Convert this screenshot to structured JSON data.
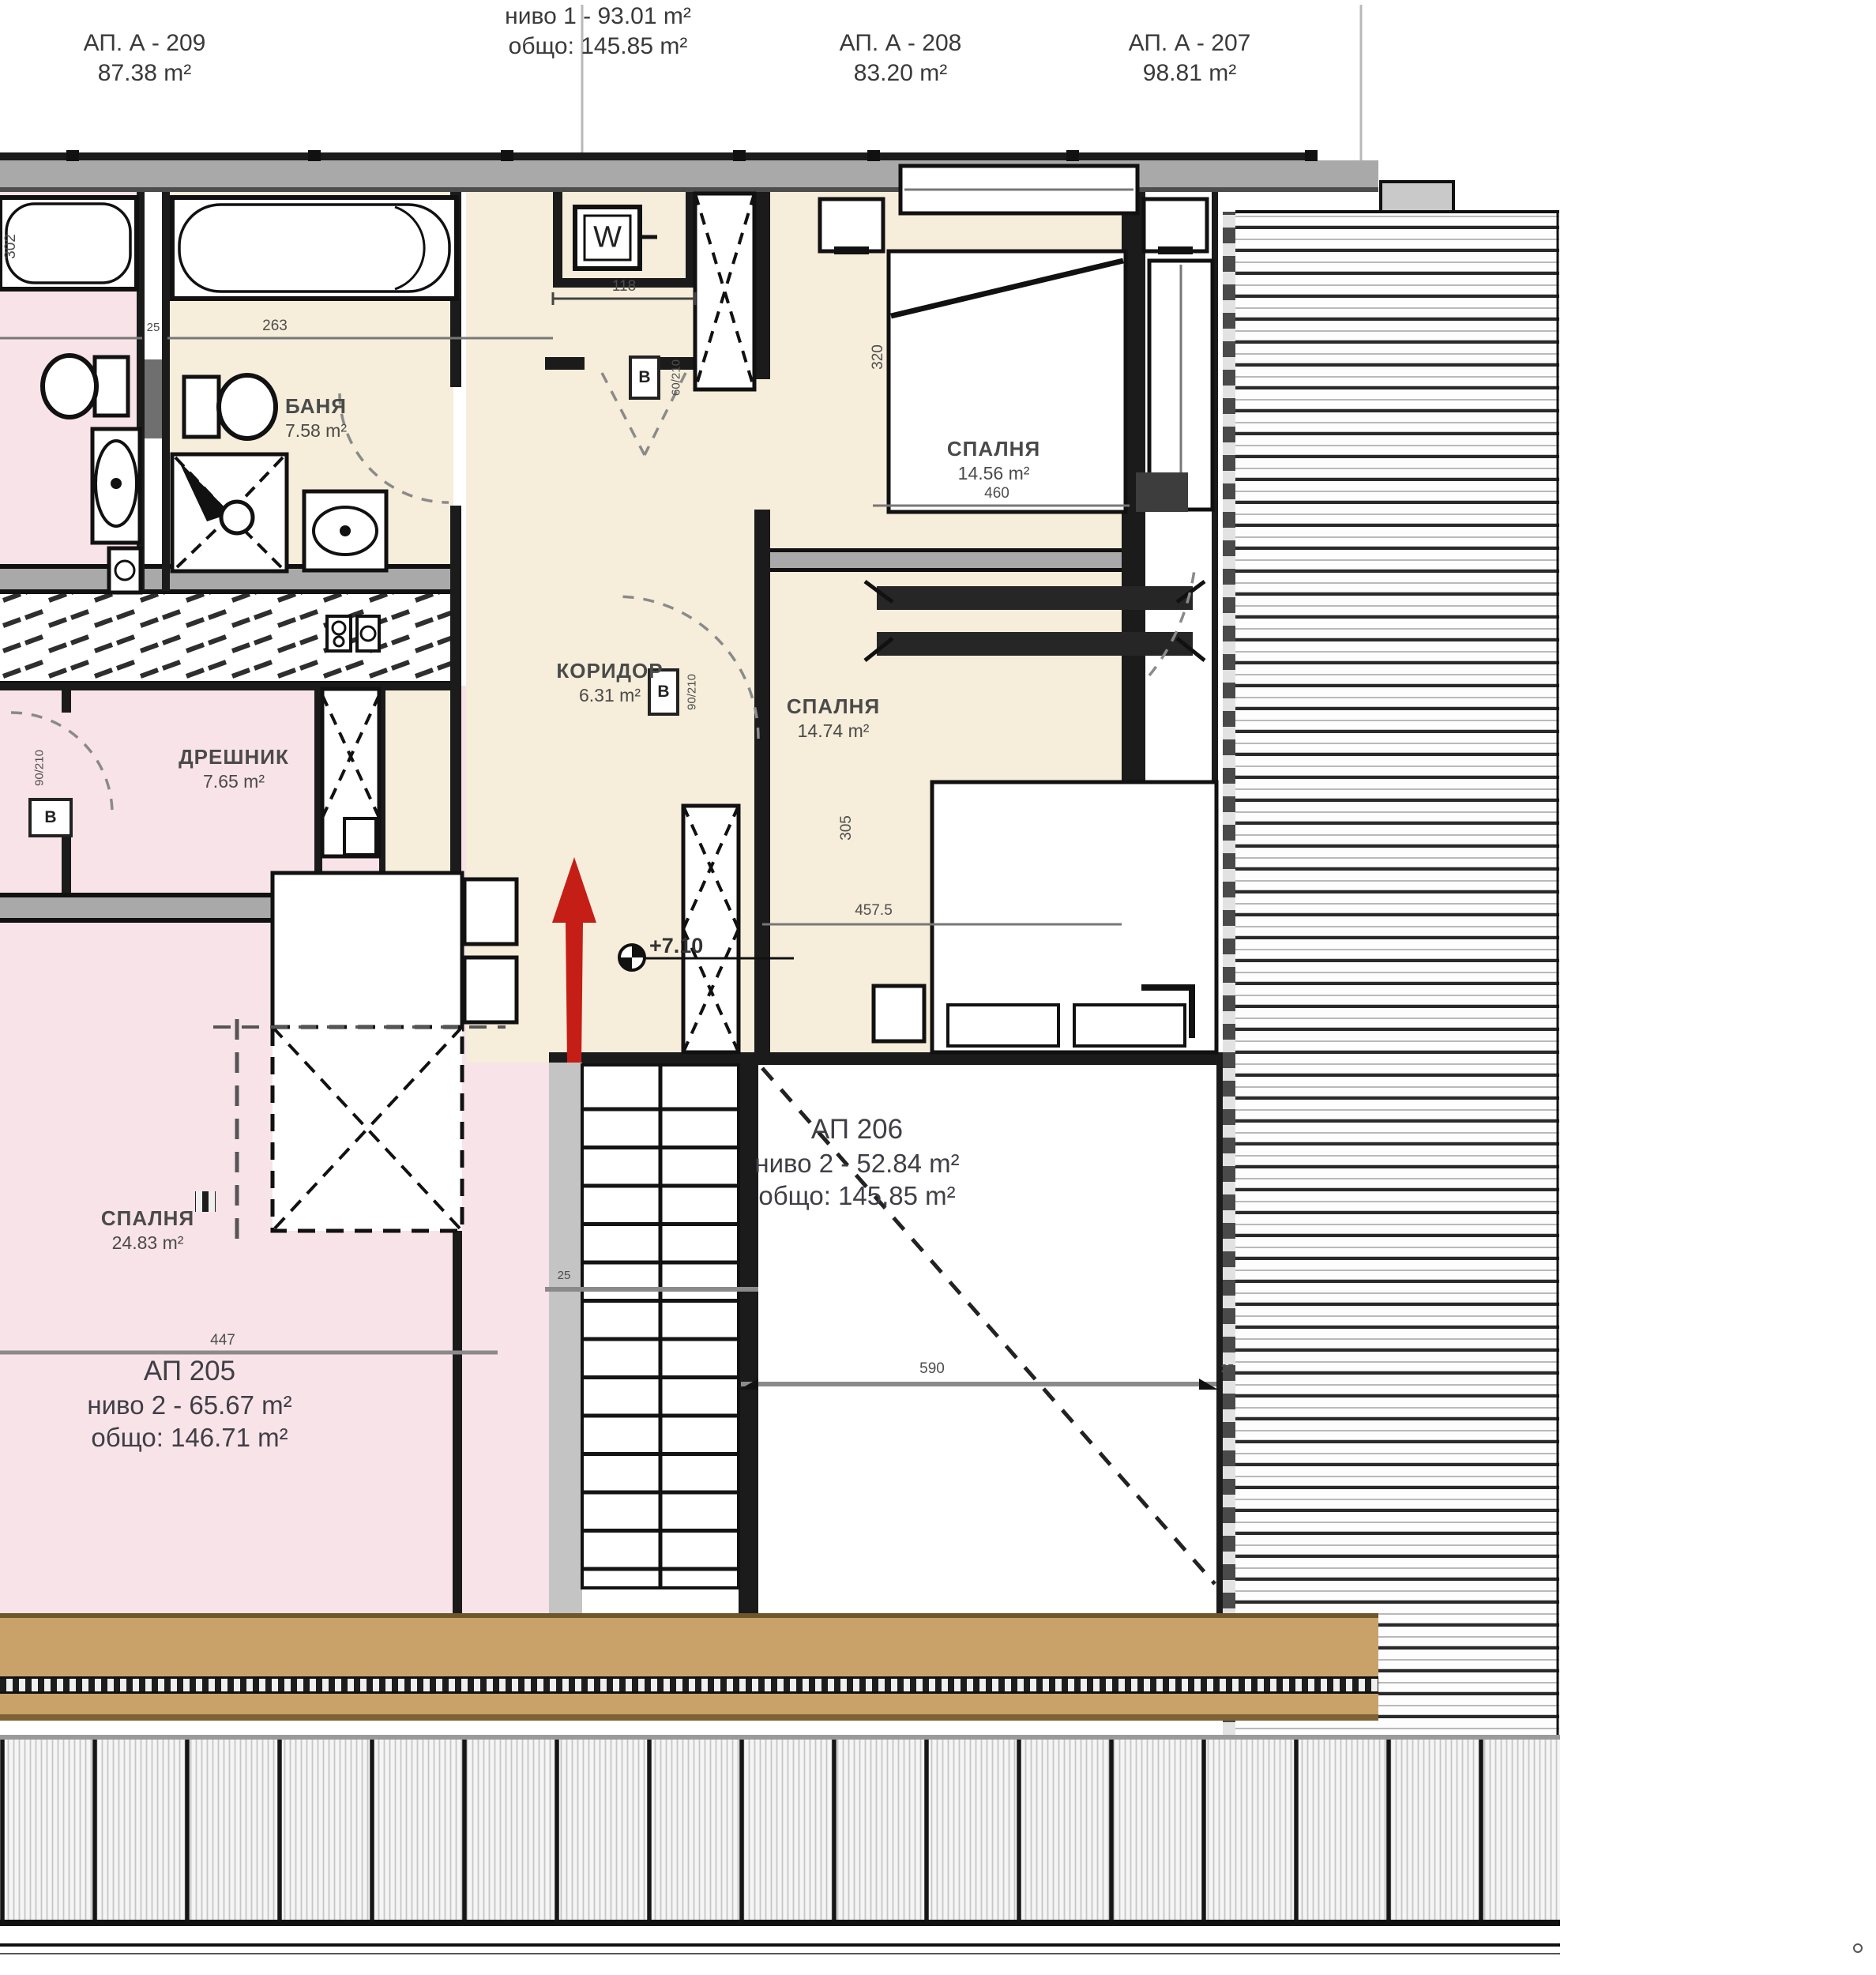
{
  "header": {
    "ap209": {
      "title": "АП. А - 209",
      "area": "87.38 m²"
    },
    "level1": {
      "line1": "ниво 1 - 93.01 m²",
      "line2": "общо: 145.85 m²"
    },
    "ap208": {
      "title": "АП. А - 208",
      "area": "83.20 m²"
    },
    "ap207": {
      "title": "АП. А - 207",
      "area": "98.81 m²"
    }
  },
  "rooms": {
    "banya": {
      "name": "БАНЯ",
      "area": "7.58 m²"
    },
    "koridor": {
      "name": "КОРИДОР",
      "area": "6.31 m²"
    },
    "bedroom_top": {
      "name": "СПАЛНЯ",
      "area": "14.56 m²"
    },
    "bedroom_mid": {
      "name": "СПАЛНЯ",
      "area": "14.74 m²"
    },
    "dreshnik": {
      "name": "ДРЕШНИК",
      "area": "7.65 m²"
    },
    "bedroom_left": {
      "name": "СПАЛНЯ",
      "area": "24.83 m²"
    }
  },
  "apartments": {
    "ap205": {
      "title": "АП 205",
      "line1": "ниво 2 - 65.67 m²",
      "line2": "общо: 146.71 m²"
    },
    "ap206": {
      "title": "АП 206",
      "line1": "ниво 2 - 52.84 m²",
      "line2": "общо: 145,85 m²"
    }
  },
  "markers": {
    "level": "+7.10",
    "washer": "W",
    "door": "B"
  },
  "dimensions": {
    "d118": "118",
    "d263": "263",
    "d460": "460",
    "d457_5": "457.5",
    "d590": "590",
    "d447": "447",
    "d92_5": "92.5",
    "d302": "302",
    "d320": "320",
    "d305": "305",
    "d25": "25",
    "door_90_210": "90/210",
    "door_60_210": "60/210"
  },
  "colors": {
    "arrow_red": "#c41e16",
    "room_pink": "#f8e3e9",
    "room_beige": "#f6edda",
    "wall_gray": "#a9a9a9",
    "eave_tan": "#c9a26a"
  }
}
